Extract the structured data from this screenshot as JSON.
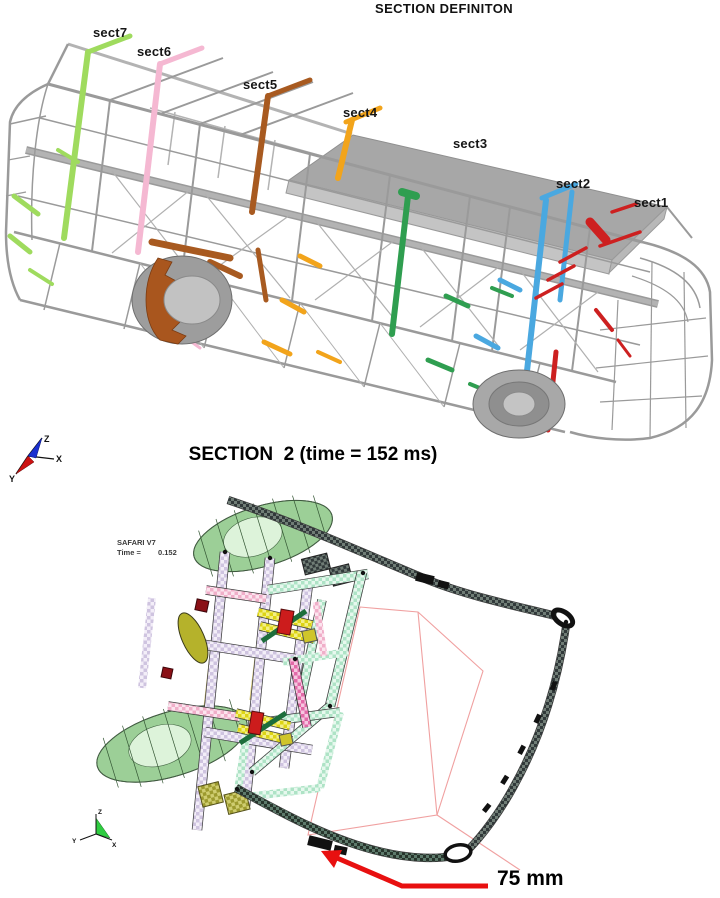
{
  "figure": {
    "top": {
      "title": "SECTION DEFINITON",
      "sections": [
        {
          "label": "sect1",
          "color": "#cd2020"
        },
        {
          "label": "sect2",
          "color": "#4aa8e0"
        },
        {
          "label": "sect3",
          "color": "#2f9e50"
        },
        {
          "label": "sect4",
          "color": "#f2a41b"
        },
        {
          "label": "sect5",
          "color": "#a85a20"
        },
        {
          "label": "sect6",
          "color": "#f5b8d2"
        },
        {
          "label": "sect7",
          "color": "#9fdb5e"
        }
      ],
      "triad": {
        "x": "X",
        "y": "Y",
        "z": "Z"
      }
    },
    "bottom": {
      "title": "SECTION  2 (time = 152 ms)",
      "solver": "SAFARI V7",
      "time_label": "Time =",
      "time_value": "0.152",
      "annotation": "75 mm",
      "arrow_color": "#e81010",
      "triad": {
        "x": "X",
        "y": "Y",
        "z": "Z"
      }
    }
  }
}
